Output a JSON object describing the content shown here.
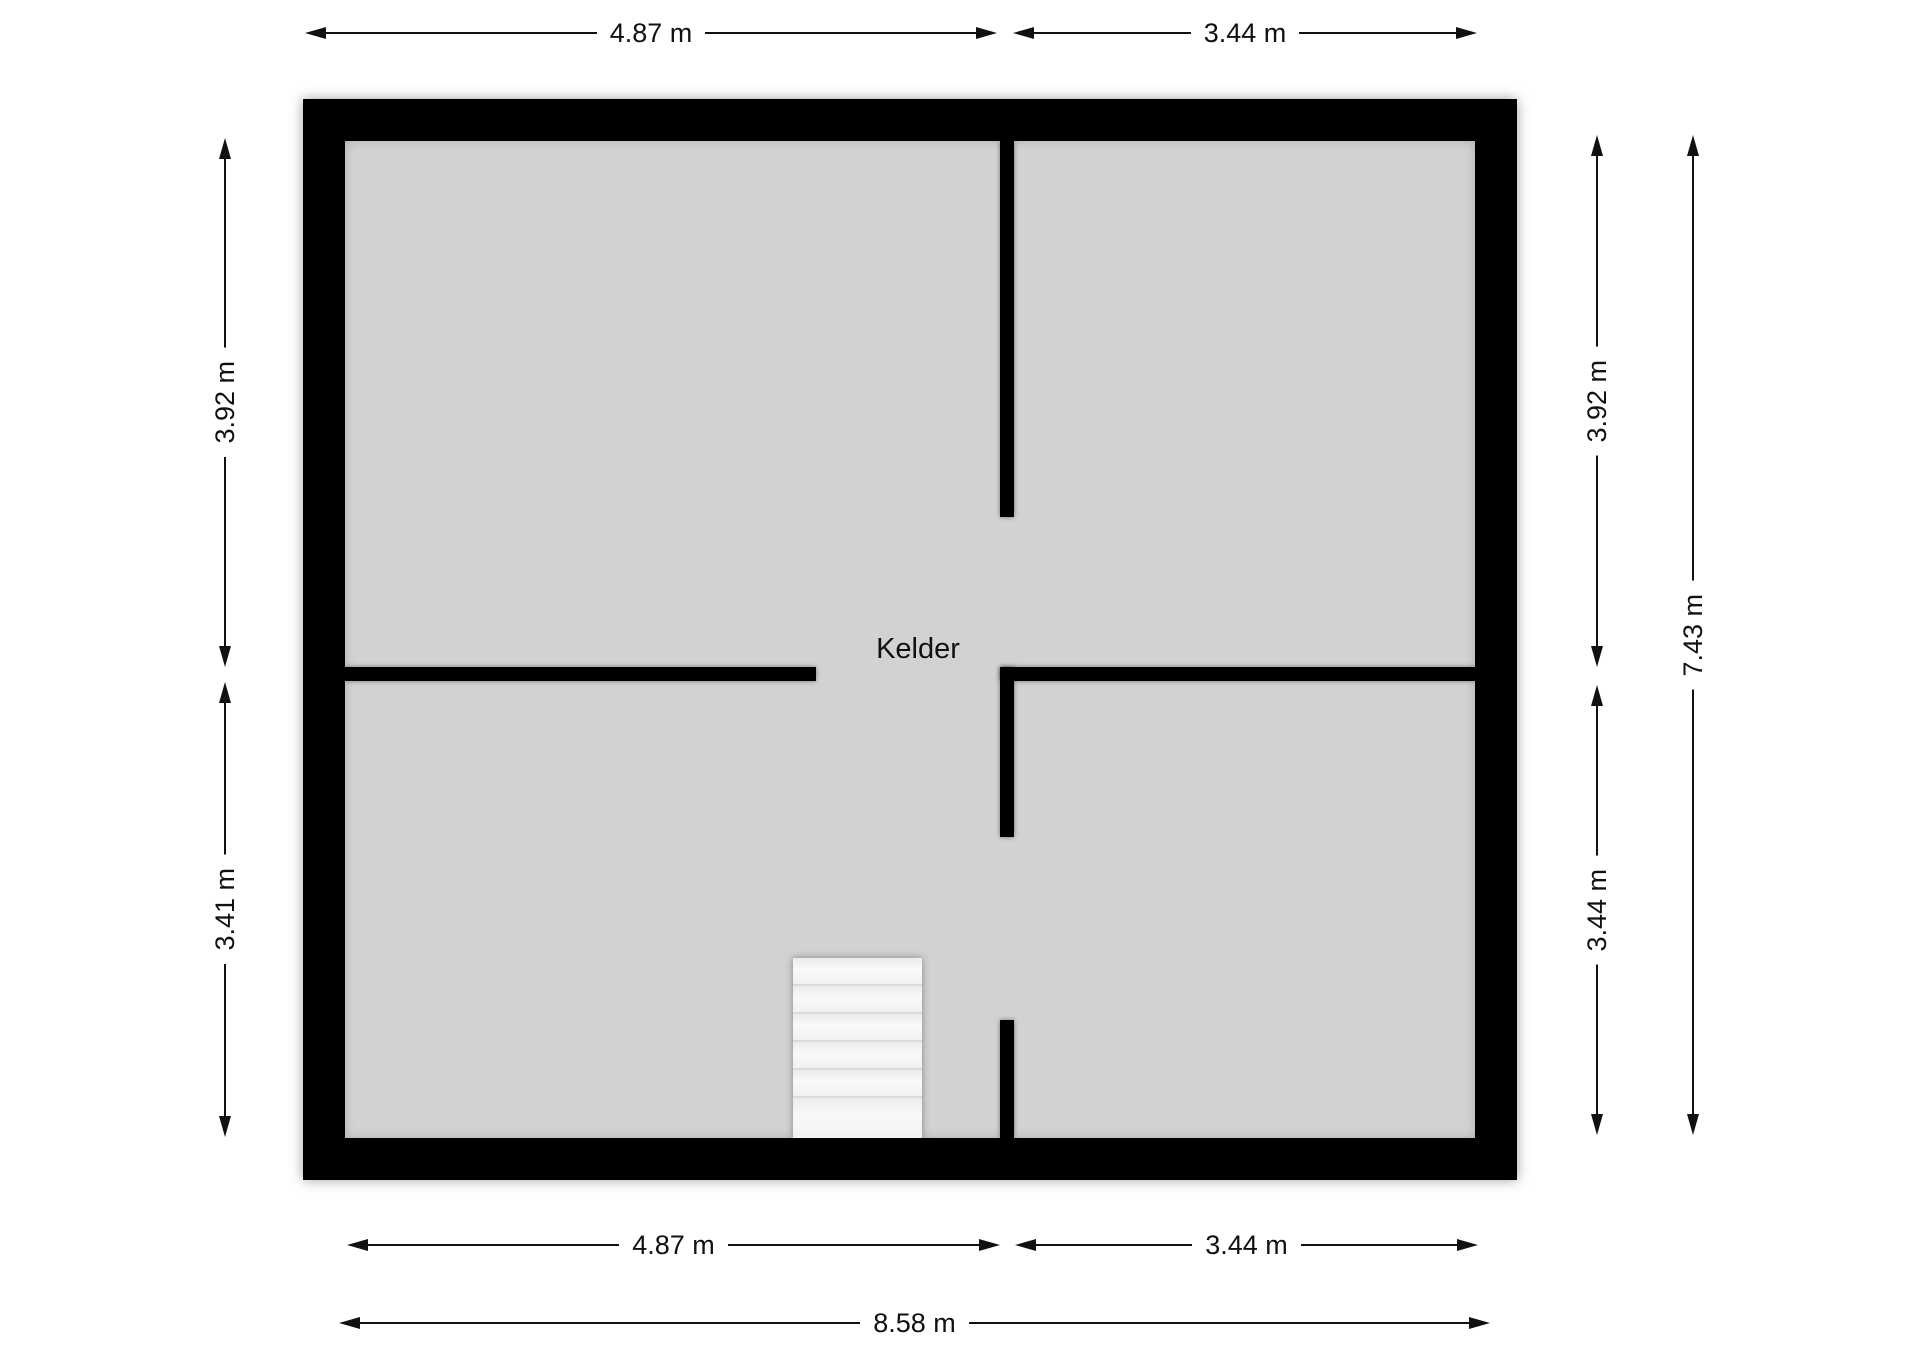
{
  "plan": {
    "room_label": "Kelder",
    "colors": {
      "wall": "#000000",
      "floor": "#d2d2d2",
      "background": "#ffffff",
      "dimension_lines": "#111111",
      "stairs": "#f4f4f4"
    }
  },
  "dimensions": {
    "unit": "m",
    "top": [
      {
        "label": "4.87 m",
        "value_m": 4.87
      },
      {
        "label": "3.44 m",
        "value_m": 3.44
      }
    ],
    "bottom": [
      {
        "label": "4.87 m",
        "value_m": 4.87
      },
      {
        "label": "3.44 m",
        "value_m": 3.44
      },
      {
        "label": "8.58 m",
        "value_m": 8.58
      }
    ],
    "left": [
      {
        "label": "3.92 m",
        "value_m": 3.92
      },
      {
        "label": "3.41 m",
        "value_m": 3.41
      }
    ],
    "right": [
      {
        "label": "3.92 m",
        "value_m": 3.92
      },
      {
        "label": "3.44 m",
        "value_m": 3.44
      },
      {
        "label": "7.43 m",
        "value_m": 7.43
      }
    ]
  }
}
